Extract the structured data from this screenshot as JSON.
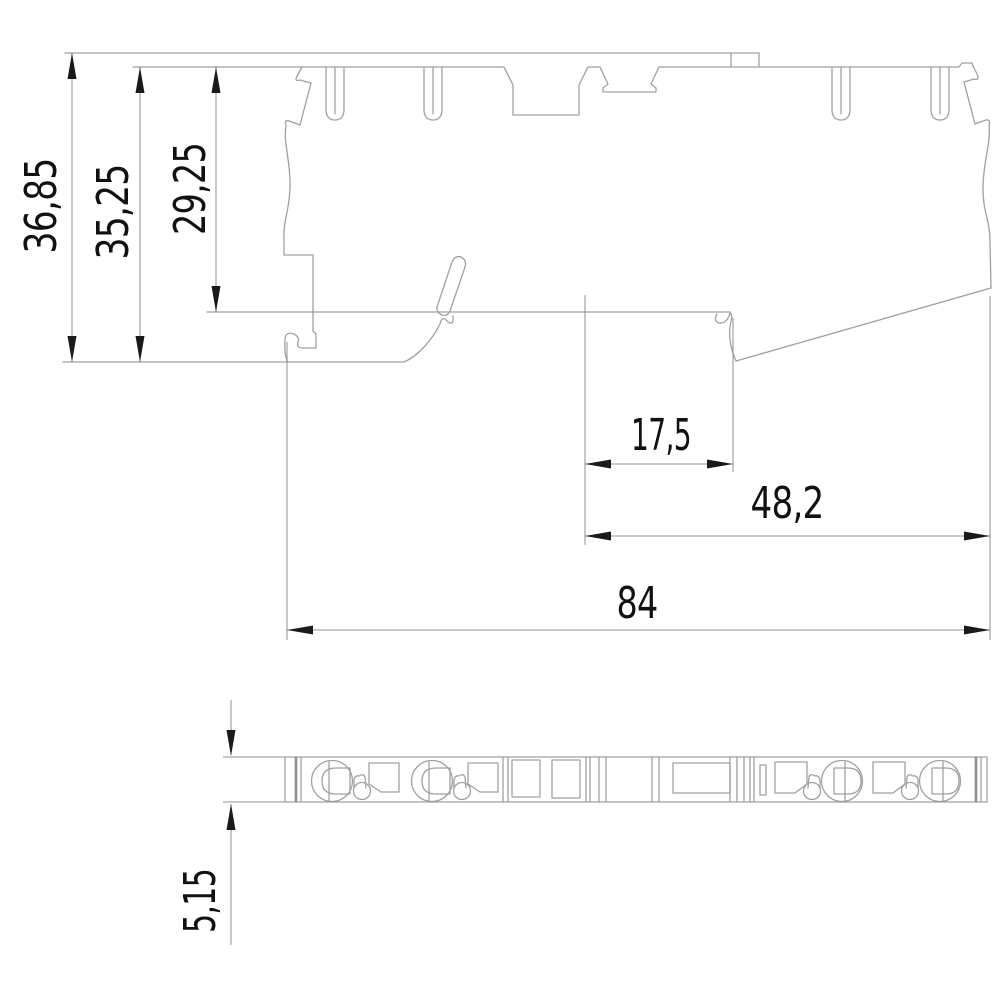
{
  "drawing": {
    "type": "technical-dimension-drawing",
    "views": {
      "side_profile": "terminal block side elevation",
      "bottom_strip": "terminal block bottom view"
    },
    "dimensions": [
      {
        "id": "overall-height",
        "value": "36,85",
        "orientation": "vertical"
      },
      {
        "id": "body-height",
        "value": "35,25",
        "orientation": "vertical"
      },
      {
        "id": "upper-height",
        "value": "29,25",
        "orientation": "vertical"
      },
      {
        "id": "notch-width",
        "value": "17,5",
        "orientation": "horizontal"
      },
      {
        "id": "right-section-width",
        "value": "48,2",
        "orientation": "horizontal"
      },
      {
        "id": "overall-width",
        "value": "84",
        "orientation": "horizontal"
      },
      {
        "id": "strip-thickness",
        "value": "5,15",
        "orientation": "vertical"
      }
    ],
    "colors": {
      "background": "#ffffff",
      "geometry_line": "#a0a0a0",
      "dimension_line": "#8f8f8f",
      "text": "#111111",
      "arrow": "#1a1a1a"
    }
  }
}
